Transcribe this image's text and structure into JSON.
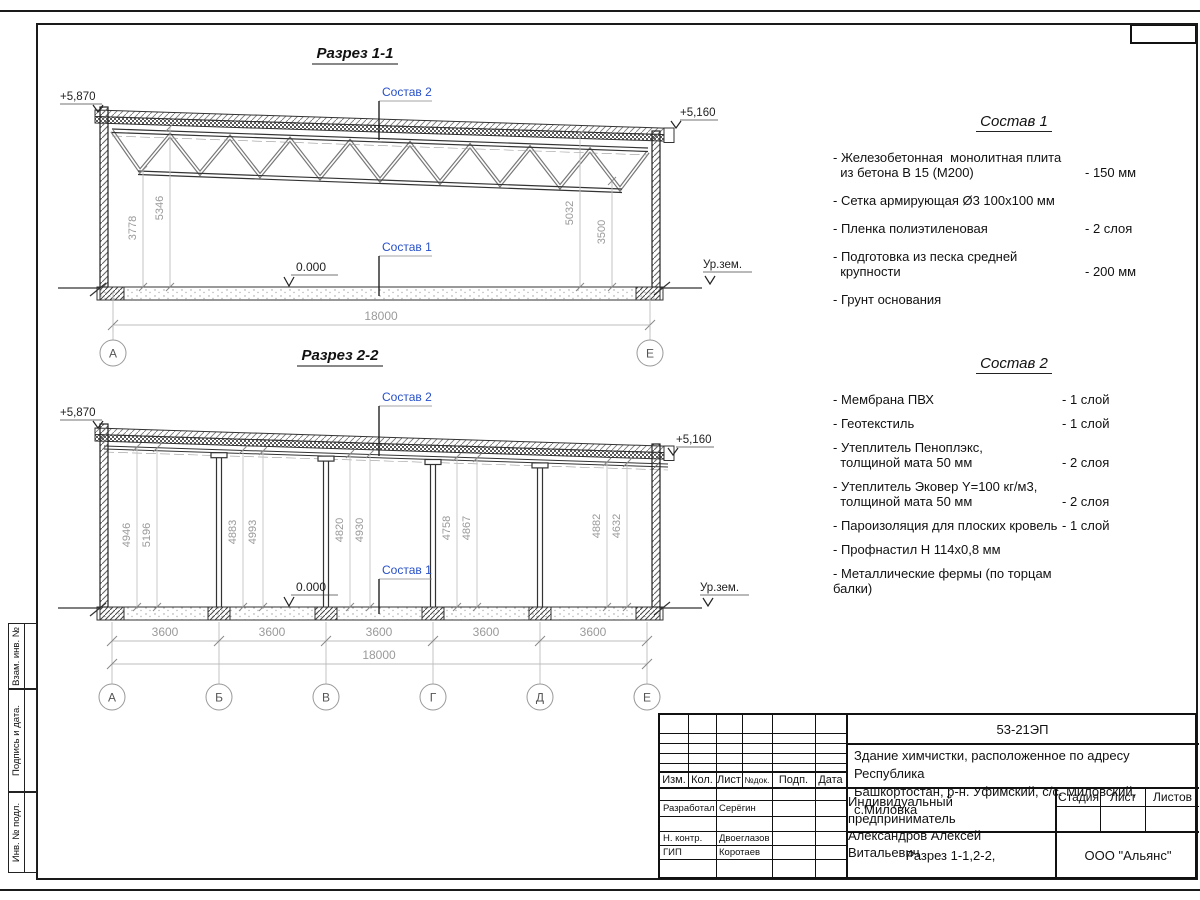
{
  "frame": {
    "side_labels": [
      "Взам. инв. №",
      "Подпись и дата.",
      "Инв. № подл."
    ]
  },
  "section1": {
    "title": "Разрез 1-1",
    "elev_left": "+5,870",
    "elev_right": "+5,160",
    "ground_label": "Ур.зем.",
    "zero_level": "0.000",
    "comp2_ref": "Состав 2",
    "comp1_ref": "Состав 1",
    "dim_left_inner": "3778",
    "dim_left_outer": "5346",
    "dim_right_inner": "5032",
    "dim_right_outer": "3500",
    "dim_total": "18000",
    "axes": [
      "А",
      "Е"
    ]
  },
  "section2": {
    "title": "Разрез 2-2",
    "elev_left": "+5,870",
    "elev_right": "+5,160",
    "ground_label": "Ур.зем.",
    "zero_level": "0.000",
    "comp2_ref": "Состав 2",
    "comp1_ref": "Состав 1",
    "bay_dims": [
      "3600",
      "3600",
      "3600",
      "3600",
      "3600"
    ],
    "dim_total": "18000",
    "axes": [
      "А",
      "Б",
      "В",
      "Г",
      "Д",
      "Е"
    ],
    "heights": [
      [
        "4946",
        "5196"
      ],
      [
        "4883",
        "4993"
      ],
      [
        "4820",
        "4930"
      ],
      [
        "4758",
        "4867"
      ],
      [
        "4882",
        "4632"
      ]
    ]
  },
  "comp1": {
    "title": "Состав 1",
    "items": [
      {
        "name": "- Железобетонная  монолитная плита\n  из бетона В 15 (М200)",
        "value": "- 150 мм"
      },
      {
        "name": "- Сетка армирующая Ø3 100х100 мм",
        "value": ""
      },
      {
        "name": "- Пленка полиэтиленовая",
        "value": "-  2 слоя"
      },
      {
        "name": "- Подготовка из песка средней\n  крупности",
        "value": "- 200 мм"
      },
      {
        "name": "- Грунт основания",
        "value": ""
      }
    ]
  },
  "comp2": {
    "title": "Состав 2",
    "items": [
      {
        "name": "- Мембрана ПВХ",
        "value": "- 1 слой"
      },
      {
        "name": "- Геотекстиль",
        "value": "- 1 слой"
      },
      {
        "name": "- Утеплитель Пеноплэкс,\n  толщиной мата 50 мм",
        "value": "- 2 слоя"
      },
      {
        "name": "- Утеплитель Эковер Y=100 кг/м3,\n  толщиной мата 50 мм",
        "value": "- 2 слоя"
      },
      {
        "name": "- Пароизоляция для плоских кровель",
        "value": "- 1 слой"
      },
      {
        "name": "- Профнастил Н 114х0,8 мм",
        "value": ""
      },
      {
        "name": "- Металлические фермы (по торцам балки)",
        "value": ""
      }
    ]
  },
  "title_block": {
    "code": "53-21ЭП",
    "project_line1": "Здание химчистки,  расположенное по адресу Республика",
    "project_line2": "Башкортостан, р-н. Уфимский, с/с. Миловский, с.Миловка",
    "header_cols": [
      "Изм.",
      "Кол.",
      "Лист",
      "№док.",
      "Подп.",
      "Дата"
    ],
    "rows": [
      {
        "role": "Разработал",
        "name": "Серёгин"
      },
      {
        "role": "Н. контр.",
        "name": "Двоеглазов"
      },
      {
        "role": "ГИП",
        "name": "Коротаев"
      }
    ],
    "client_line1": "Индивидуальный предприниматель",
    "client_line2": "Александров Алексей Витальевич",
    "stage_cols": [
      "Стадия",
      "Лист",
      "Листов"
    ],
    "sheet_title": "Разрез 1-1,2-2,",
    "company": "ООО \"Альянс\""
  },
  "colors": {
    "accent_blue": "#2850c8",
    "dim_gray": "#9a9a9a",
    "line": "#1a1a1a"
  }
}
